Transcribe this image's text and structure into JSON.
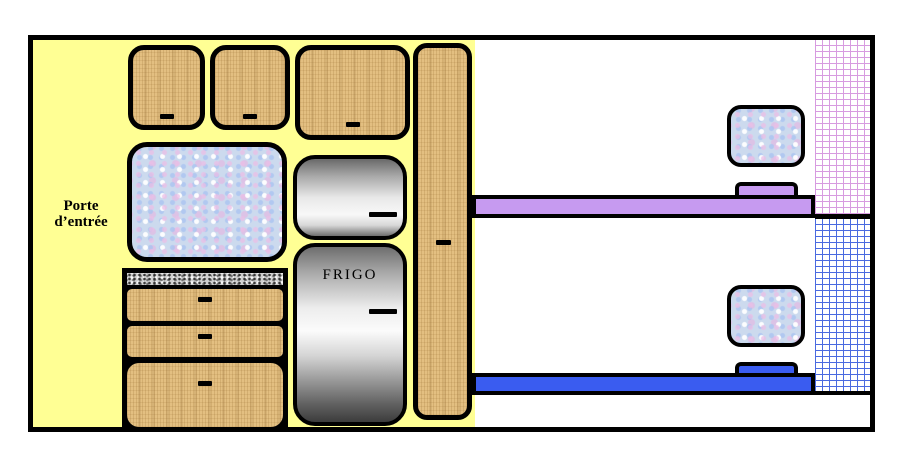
{
  "labels": {
    "entrance_door": {
      "line1": "Porte",
      "line2": "d’entrée"
    },
    "fridge": "FRIGO"
  },
  "colors": {
    "background": "#FFFFFF",
    "floor": "#FFFF94",
    "outline": "#000000",
    "wood": "#E3BF81",
    "marble": "#CCDAEE",
    "counter": "#CFCFCF",
    "top_bunk": "#C69AF0",
    "bottom_bunk": "#3A5CF0",
    "brick_pink": "#D79BE0",
    "brick_blue": "#4A6AE0"
  }
}
